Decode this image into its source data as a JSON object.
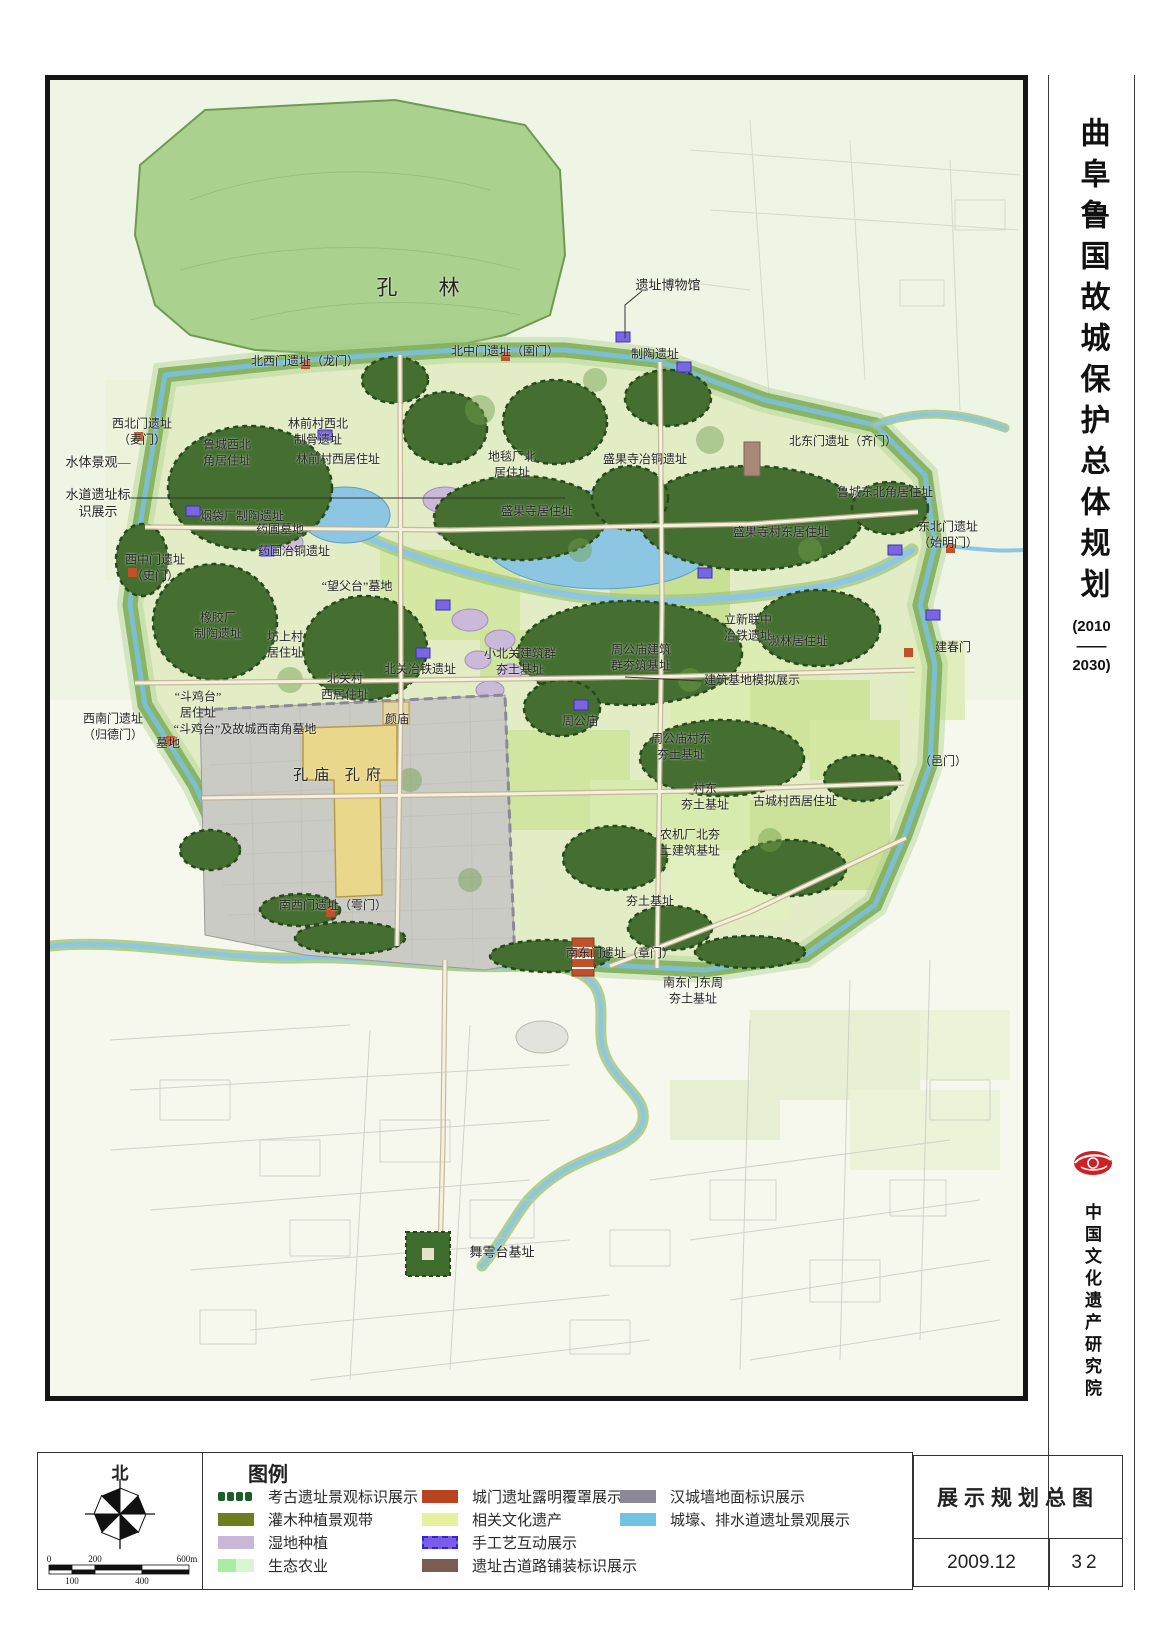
{
  "sidebar": {
    "title": "曲阜鲁国故城保护总体规划",
    "subtitle_lines": [
      "(2010",
      "——",
      "2030)"
    ],
    "organization": "中国文化遗产研究院",
    "logo_color": "#cc2127"
  },
  "titleblock": {
    "drawing_title": "展示规划总图",
    "date": "2009.12",
    "page_number": "32"
  },
  "compass": {
    "north_label": "北"
  },
  "scalebar": {
    "t0": "0",
    "t200": "200",
    "t600": "600m",
    "b100": "100",
    "b400": "400"
  },
  "legend": {
    "title": "图例",
    "columns": [
      [
        {
          "label": "考古遗址景观标识展示",
          "type": "dots",
          "color": "#1e5c28"
        },
        {
          "label": "灌木种植景观带",
          "type": "solid",
          "color": "#6e7e1e"
        },
        {
          "label": "湿地种植",
          "type": "solid",
          "color": "#c9b7d8"
        },
        {
          "label": "生态农业",
          "type": "duo",
          "color": "#a9eda2",
          "color2": "#d9f6d2"
        }
      ],
      [
        {
          "label": "城门遗址露明覆罩展示",
          "type": "solid",
          "color": "#b8441d"
        },
        {
          "label": "相关文化遗产",
          "type": "solid",
          "color": "#e7f09e"
        },
        {
          "label": "手工艺互动展示",
          "type": "dashed",
          "color": "#7a5ce8",
          "color2": "#2a2ad0"
        },
        {
          "label": "遗址古道路铺装标识展示",
          "type": "solid",
          "color": "#7d5c52"
        }
      ],
      [
        {
          "label": "汉城墙地面标识展示",
          "type": "solid",
          "color": "#8d8896"
        },
        {
          "label": "城壕、排水道遗址景观展示",
          "type": "solid",
          "color": "#72c2e4"
        }
      ]
    ]
  },
  "map": {
    "labels": [
      {
        "t": "孔  林",
        "x": 377,
        "y": 208,
        "fs": 21,
        "ls": 18
      },
      {
        "t": "遗址博物馆",
        "x": 618,
        "y": 206,
        "fs": 13
      },
      {
        "t": "北中门遗址（圉门）",
        "x": 455,
        "y": 272
      },
      {
        "t": "北西门遗址（龙门）",
        "x": 255,
        "y": 282
      },
      {
        "t": "制陶遗址",
        "x": 605,
        "y": 275
      },
      {
        "t": "北东门遗址（齐门）",
        "x": 793,
        "y": 362
      },
      {
        "t": "西北门遗址\n（麦门）",
        "x": 92,
        "y": 352
      },
      {
        "t": "鲁城西北\n角居住址",
        "x": 177,
        "y": 373
      },
      {
        "t": "林前村西北\n制骨遗址",
        "x": 268,
        "y": 352
      },
      {
        "t": "林前村西居住址",
        "x": 288,
        "y": 380
      },
      {
        "t": "地毯厂北\n居住址",
        "x": 462,
        "y": 385
      },
      {
        "t": "盛果寺冶铜遗址",
        "x": 595,
        "y": 380
      },
      {
        "t": "鲁城东北角居住址",
        "x": 835,
        "y": 413
      },
      {
        "t": "水体景观—",
        "x": 48,
        "y": 383,
        "fs": 13
      },
      {
        "t": "水道遗址标\n识展示",
        "x": 48,
        "y": 424,
        "fs": 13
      },
      {
        "t": "烟袋厂制陶遗址",
        "x": 192,
        "y": 437
      },
      {
        "t": "盛果寺居住址",
        "x": 487,
        "y": 432
      },
      {
        "t": "盛果寺村东居住址",
        "x": 731,
        "y": 453
      },
      {
        "t": "东北门遗址\n（始明门）",
        "x": 898,
        "y": 455
      },
      {
        "t": "药圃墓地",
        "x": 230,
        "y": 450
      },
      {
        "t": "药圃冶铜遗址",
        "x": 244,
        "y": 472
      },
      {
        "t": "西中门遗址\n（史门）",
        "x": 105,
        "y": 488
      },
      {
        "t": "“望父台”墓地",
        "x": 307,
        "y": 507
      },
      {
        "t": "立新联中\n冶铁遗址",
        "x": 698,
        "y": 548
      },
      {
        "t": "橡胶厂\n制陶遗址",
        "x": 168,
        "y": 546
      },
      {
        "t": "坊上村\n居住址",
        "x": 235,
        "y": 565
      },
      {
        "t": "北关冶铁遗址",
        "x": 370,
        "y": 590
      },
      {
        "t": "小北关建筑群\n夯土基址",
        "x": 470,
        "y": 582
      },
      {
        "t": "濒林居住址",
        "x": 748,
        "y": 562
      },
      {
        "t": "周公庙建筑\n群夯筑基址",
        "x": 591,
        "y": 578
      },
      {
        "t": "建筑基地模拟展示",
        "x": 702,
        "y": 601
      },
      {
        "t": "建春门",
        "x": 903,
        "y": 568
      },
      {
        "t": "北关村\n西居住址",
        "x": 295,
        "y": 607
      },
      {
        "t": "“斗鸡台”\n居住址",
        "x": 148,
        "y": 625
      },
      {
        "t": "西南门遗址\n（归德门）",
        "x": 63,
        "y": 647
      },
      {
        "t": "“斗鸡台”及故城西南角墓地",
        "x": 195,
        "y": 650
      },
      {
        "t": "墓地",
        "x": 118,
        "y": 664
      },
      {
        "t": "周公庙",
        "x": 530,
        "y": 642
      },
      {
        "t": "颜庙",
        "x": 347,
        "y": 640
      },
      {
        "t": "周公庙村东\n夯土基址",
        "x": 631,
        "y": 667
      },
      {
        "t": "村东\n夯土基址",
        "x": 655,
        "y": 717
      },
      {
        "t": "古城村西居住址",
        "x": 745,
        "y": 722
      },
      {
        "t": "（邑门）",
        "x": 893,
        "y": 682
      },
      {
        "t": "孔庙  孔府",
        "x": 290,
        "y": 696,
        "fs": 15,
        "ls": 6
      },
      {
        "t": "农机厂北夯\n土建筑基址",
        "x": 640,
        "y": 763
      },
      {
        "t": "夯土基址",
        "x": 600,
        "y": 822
      },
      {
        "t": "南西门遗址（雩门）",
        "x": 283,
        "y": 826
      },
      {
        "t": "南东门遗址（章门）",
        "x": 570,
        "y": 874
      },
      {
        "t": "南东门东周\n夯土基址",
        "x": 643,
        "y": 911
      },
      {
        "t": "舞雩台基址",
        "x": 452,
        "y": 1173,
        "fs": 13
      }
    ]
  }
}
